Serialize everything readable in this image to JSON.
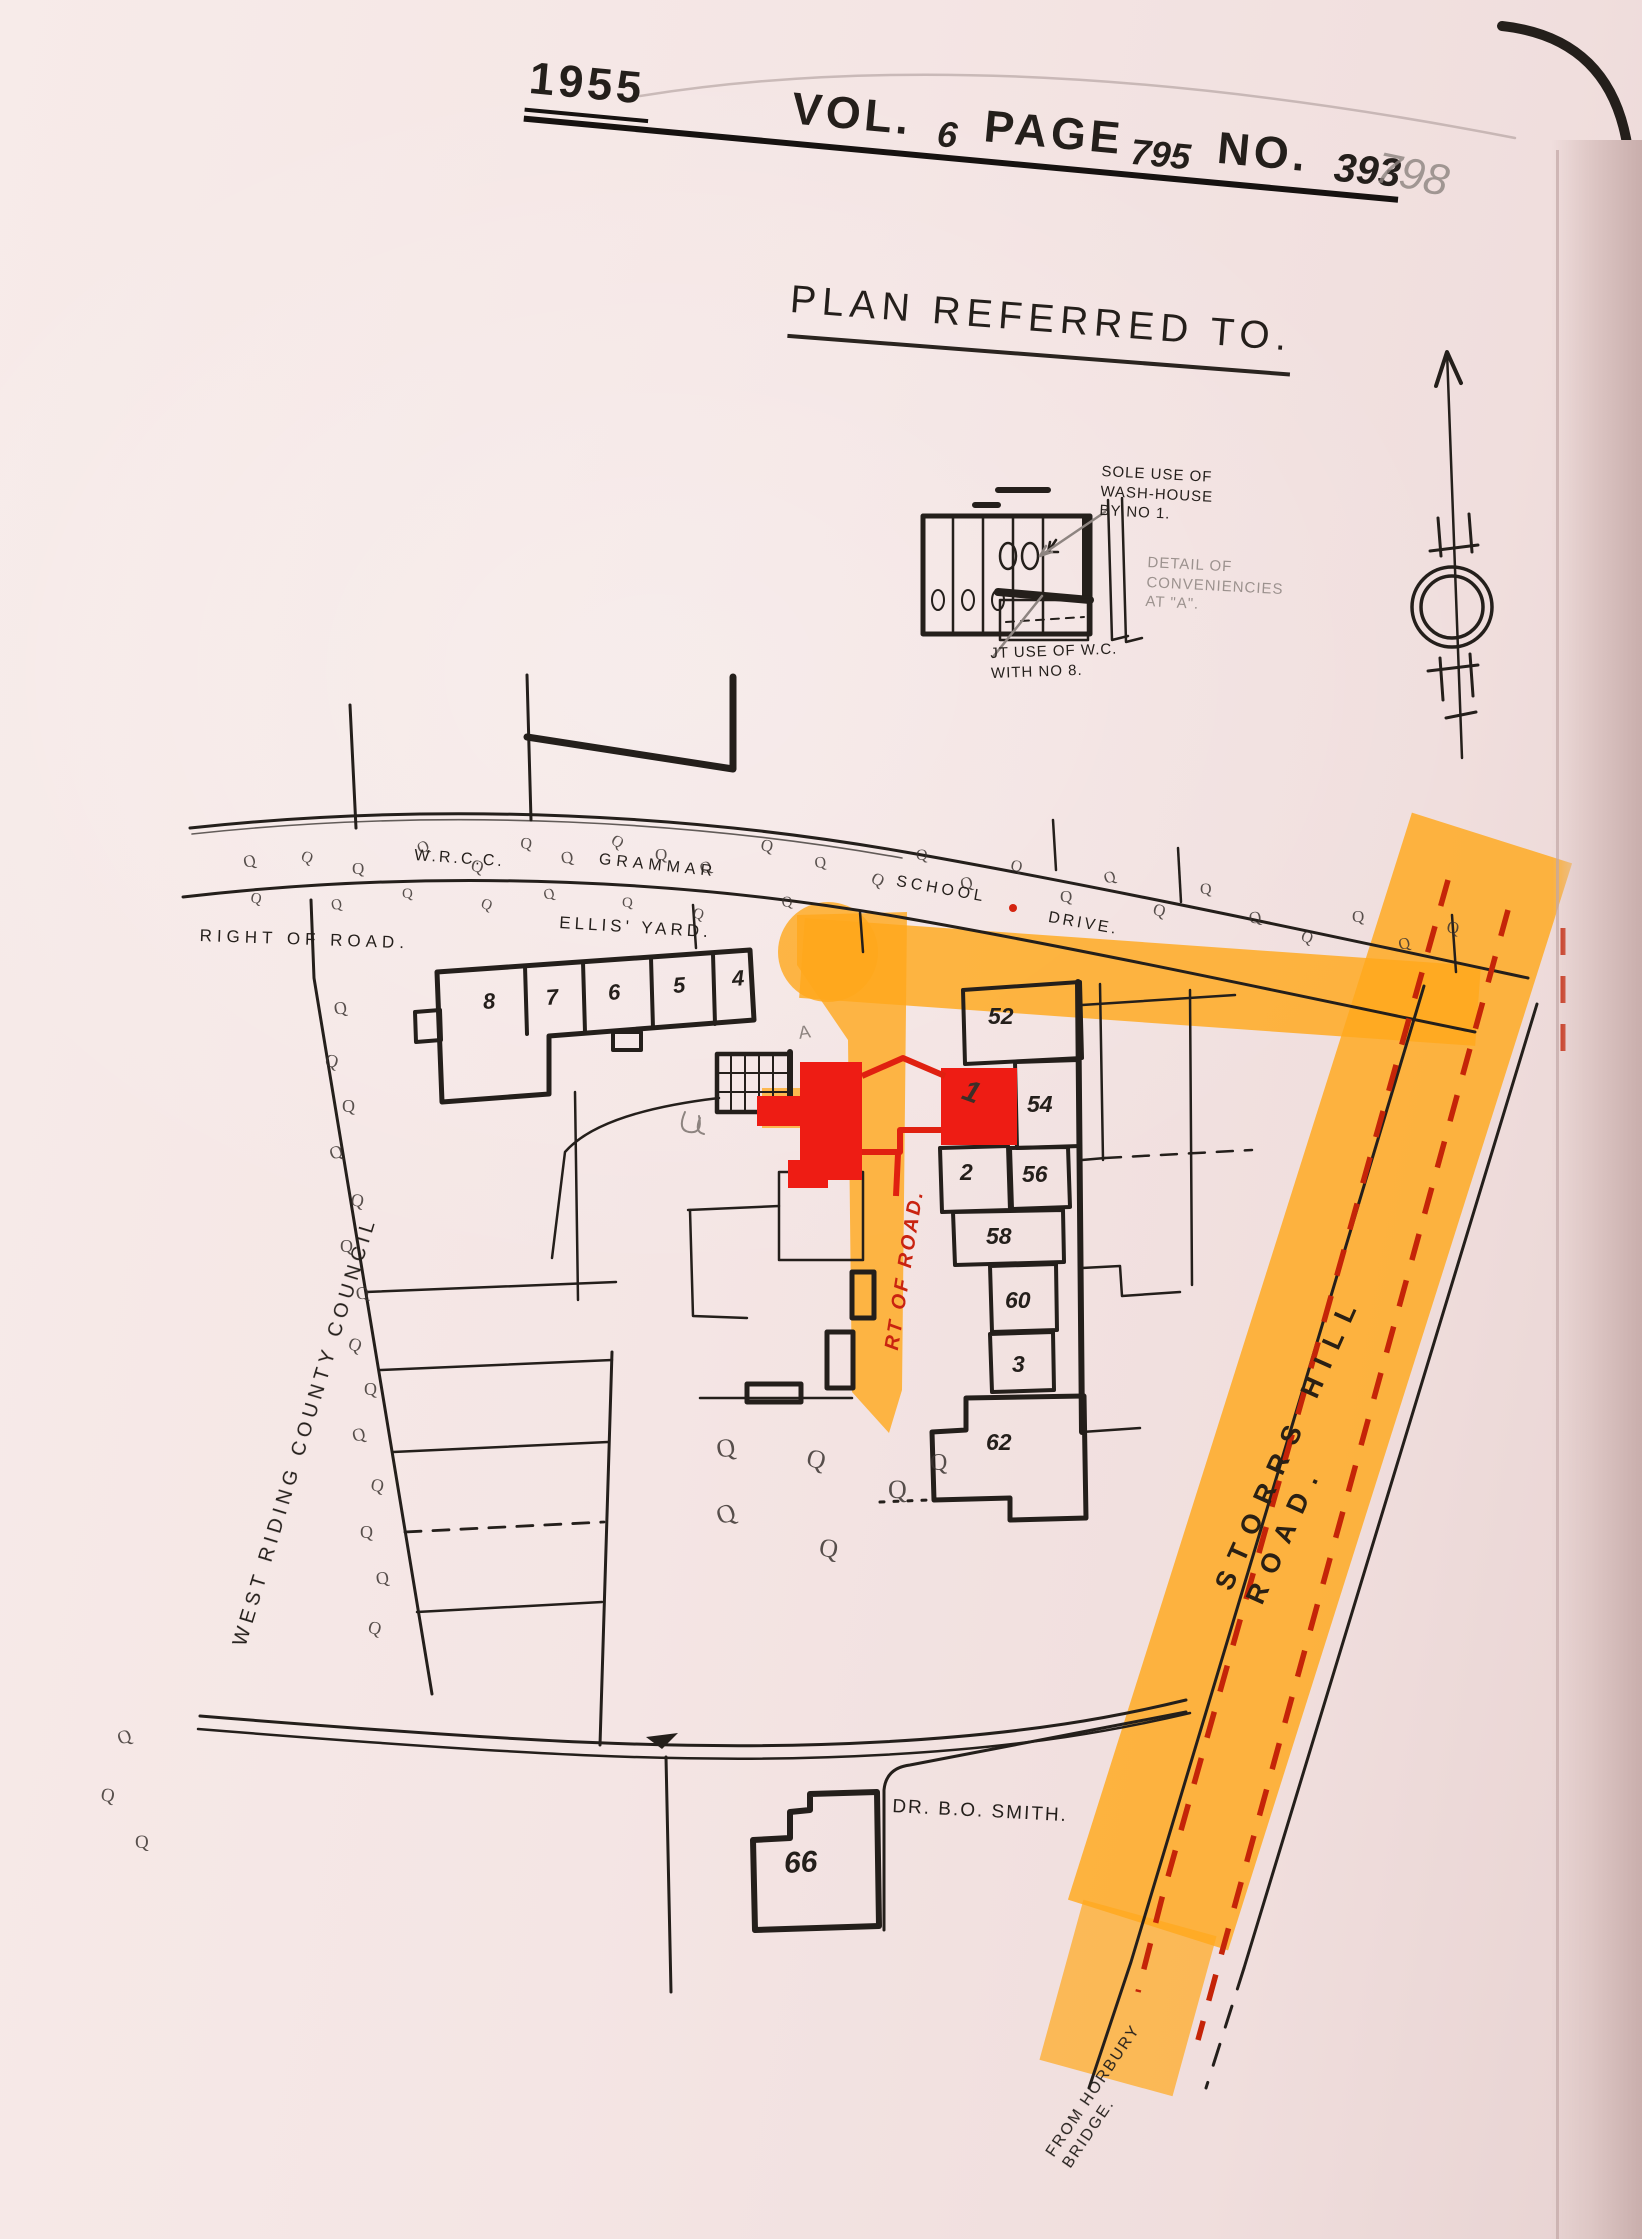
{
  "header": {
    "year": "1955",
    "vol_label": "VOL.",
    "vol_value": "6",
    "page_label": "PAGE",
    "page_value": "795",
    "no_label": "NO.",
    "no_value": "393",
    "corner_number": "798"
  },
  "title": "PLAN REFERRED TO.",
  "inset": {
    "sole_use_note": "SOLE USE OF\nWASH-HOUSE\nBY NO 1.",
    "detail_note": "DETAIL OF\nCONVENIENCIES\nAT \"A\".",
    "joint_use_note": "JT USE OF W.C.\nWITH NO 8.",
    "point_label": "A"
  },
  "roads": {
    "grammar_drive": [
      "W.R.C.C.",
      "GRAMMAR",
      "SCHOOL",
      "DRIVE."
    ],
    "right_of_road": "RIGHT OF ROAD.",
    "ellis_yard": "ELLIS' YARD.",
    "rt_of_road": "RT OF ROAD.",
    "storrs_hill": "STORRS  HILL  ROAD.",
    "from_horbury": "FROM HORBURY\nBRIDGE.",
    "west_riding": "WEST RIDING COUNTY COUNCIL"
  },
  "plots": {
    "terrace_left": [
      "8",
      "7",
      "6",
      "5",
      "4"
    ],
    "right_column": [
      "52",
      "54",
      "2",
      "56",
      "58",
      "60",
      "3",
      "62"
    ],
    "plot_1": "1",
    "house_66": "66",
    "dr_smith": "DR. B.O. SMITH."
  },
  "symbols": {
    "shrub_glyph": "Q"
  },
  "colors": {
    "paper": "#f4e5e4",
    "ink": "#241f1b",
    "pencil": "#8d8480",
    "marker_orange": "#ffa81c",
    "marker_red": "#ee1c14",
    "dash_red": "#c52408"
  }
}
